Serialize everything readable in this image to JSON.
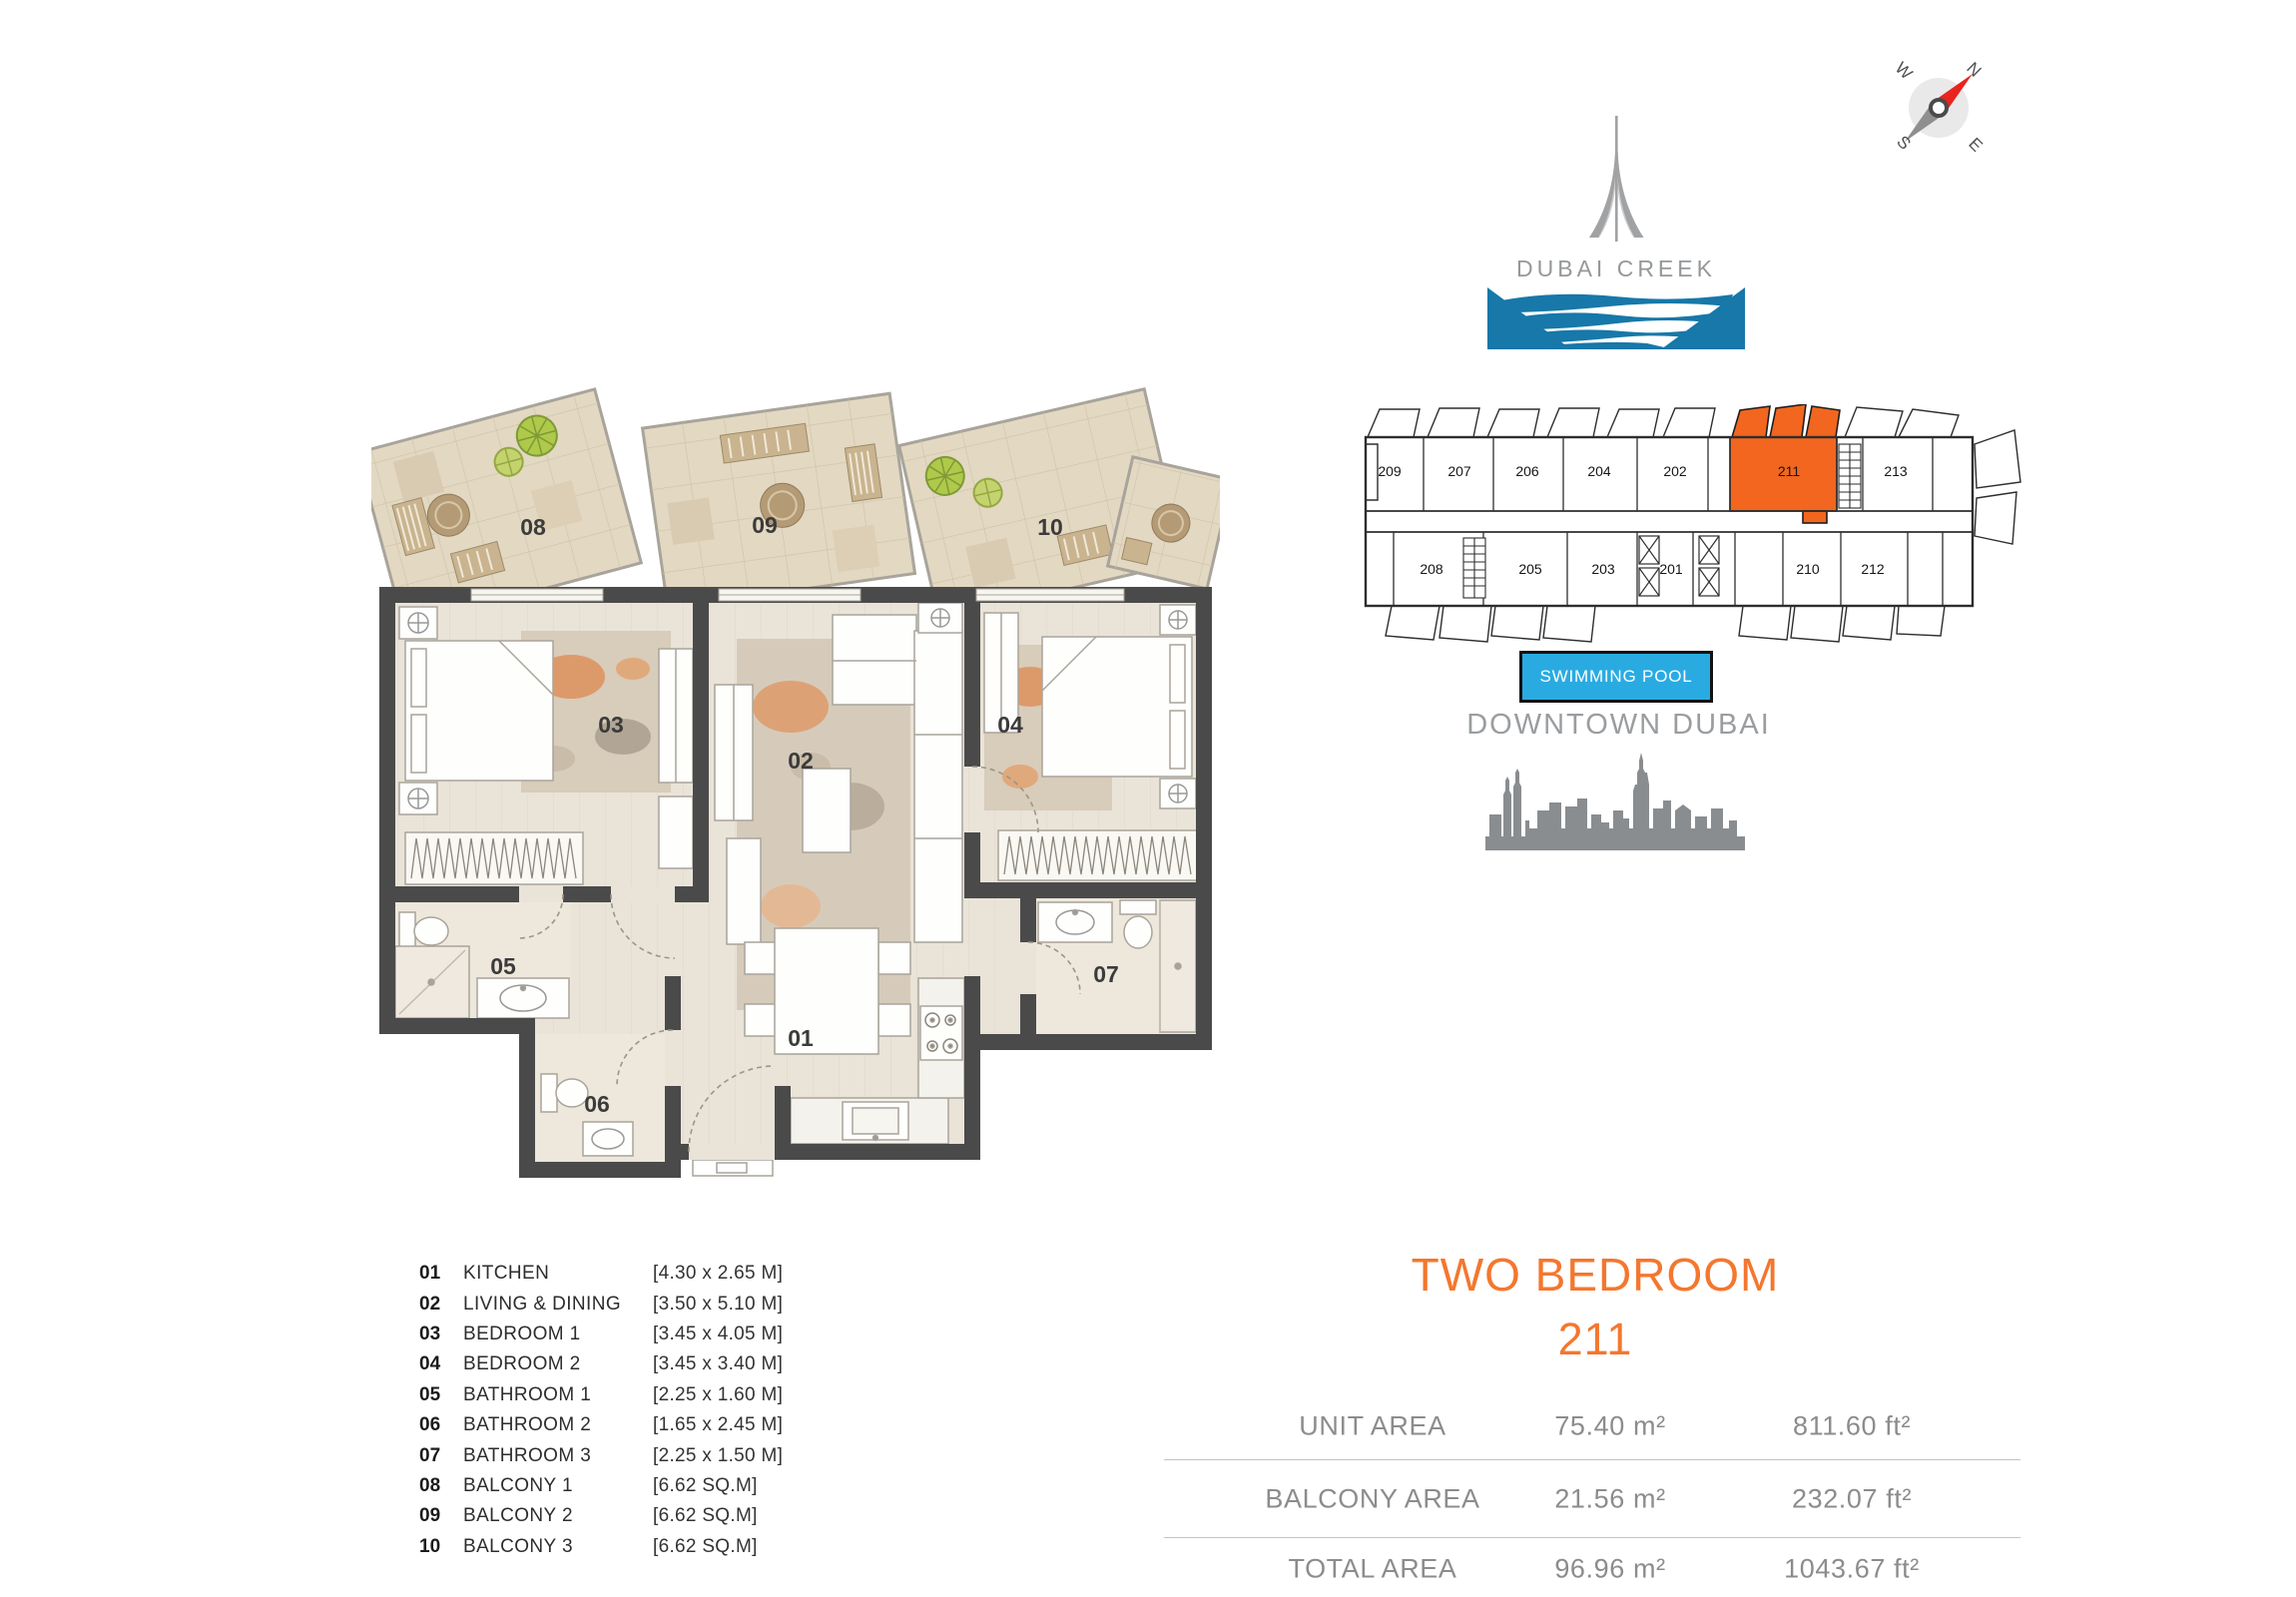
{
  "branding": {
    "logo_title": "DUBAI CREEK",
    "pool_label": "SWIMMING POOL",
    "location_label": "DOWNTOWN DUBAI"
  },
  "compass": {
    "n": "N",
    "e": "E",
    "s": "S",
    "w": "W"
  },
  "key_plan": {
    "top_units": [
      "209",
      "207",
      "206",
      "204",
      "202",
      "211",
      "213"
    ],
    "bottom_units": [
      "208",
      "205",
      "203",
      "201",
      "210",
      "212"
    ],
    "highlighted_unit": "211"
  },
  "floor_plan": {
    "labels": {
      "r01": "01",
      "r02": "02",
      "r03": "03",
      "r04": "04",
      "r05": "05",
      "r06": "06",
      "r07": "07",
      "r08": "08",
      "r09": "09",
      "r10": "10"
    }
  },
  "legend": {
    "items": [
      {
        "num": "01",
        "name": "KITCHEN",
        "dim": "[4.30 x 2.65 M]"
      },
      {
        "num": "02",
        "name": "LIVING & DINING",
        "dim": "[3.50 x 5.10 M]"
      },
      {
        "num": "03",
        "name": "BEDROOM 1",
        "dim": "[3.45 x 4.05 M]"
      },
      {
        "num": "04",
        "name": "BEDROOM 2",
        "dim": "[3.45 x 3.40 M]"
      },
      {
        "num": "05",
        "name": "BATHROOM 1",
        "dim": "[2.25 x 1.60 M]"
      },
      {
        "num": "06",
        "name": "BATHROOM 2",
        "dim": "[1.65 x 2.45 M]"
      },
      {
        "num": "07",
        "name": "BATHROOM 3",
        "dim": "[2.25 x 1.50 M]"
      },
      {
        "num": "08",
        "name": "BALCONY 1",
        "dim": "[6.62 SQ.M]"
      },
      {
        "num": "09",
        "name": "BALCONY 2",
        "dim": "[6.62 SQ.M]"
      },
      {
        "num": "10",
        "name": "BALCONY 3",
        "dim": "[6.62 SQ.M]"
      }
    ]
  },
  "summary": {
    "type_title": "TWO BEDROOM",
    "unit_number": "211",
    "rows": [
      {
        "label": "UNIT AREA",
        "metric": "75.40 m²",
        "imperial": "811.60 ft²"
      },
      {
        "label": "BALCONY AREA",
        "metric": "21.56 m²",
        "imperial": "232.07 ft²"
      },
      {
        "label": "TOTAL AREA",
        "metric": "96.96 m²",
        "imperial": "1043.67 ft²"
      }
    ]
  },
  "colors": {
    "accent_orange": "#F4772E",
    "highlight_orange": "#F2661F",
    "pool_blue": "#29ABE2",
    "water_blue": "#1778A9",
    "wall_gray": "#4A4A4A",
    "text_gray": "#8C8C8C"
  }
}
